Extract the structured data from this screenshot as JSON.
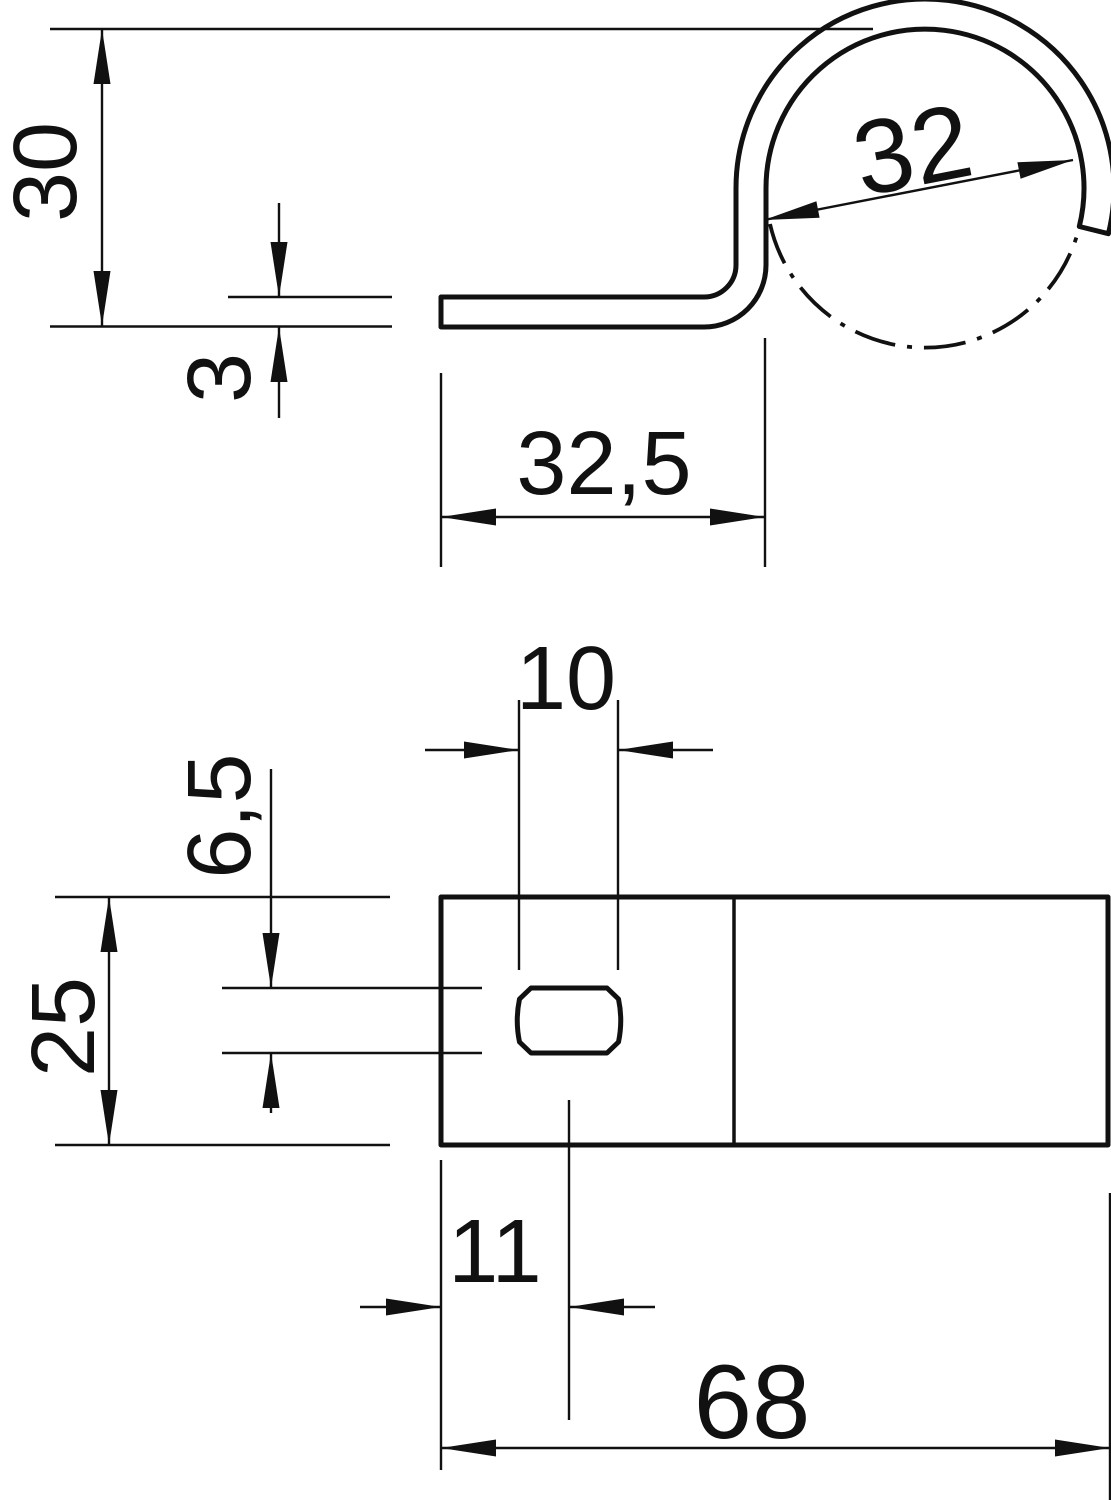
{
  "colors": {
    "line_color": "#111111",
    "background": "#ffffff"
  },
  "side_view": {
    "height": "30",
    "thickness": "3",
    "diameter": "32",
    "flat_length": "32,5"
  },
  "plan_view": {
    "slot_width": "10",
    "slot_height": "6,5",
    "width": "25",
    "hole_offset": "11",
    "length": "68"
  }
}
